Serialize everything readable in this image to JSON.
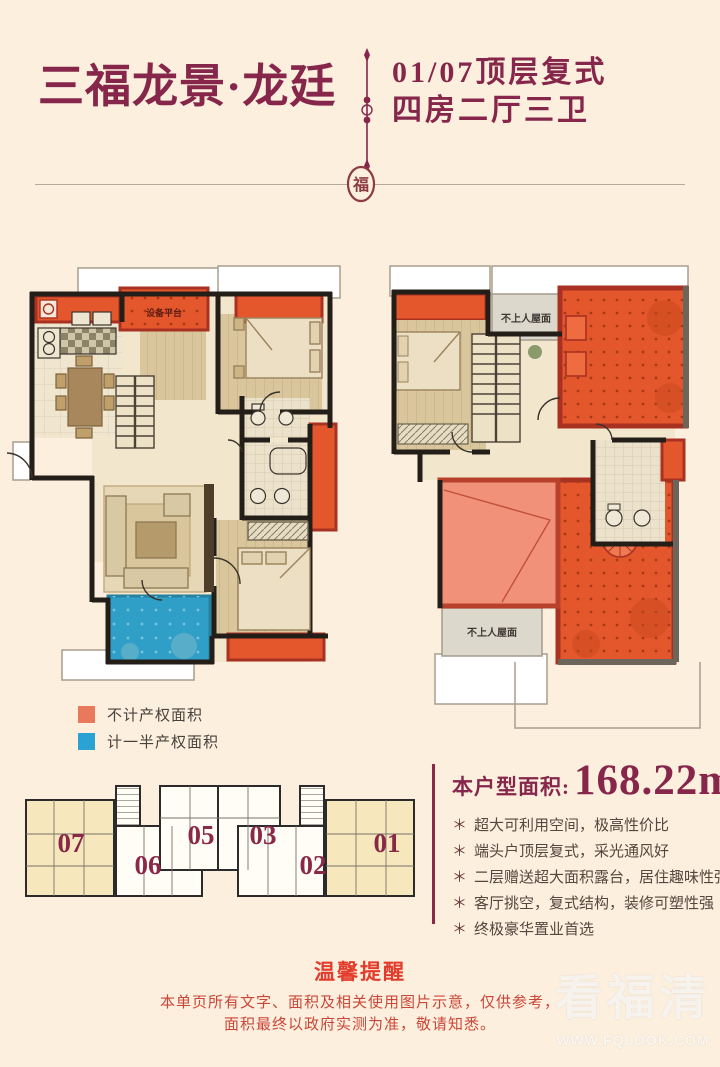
{
  "header": {
    "title": "三福龙景·龙廷",
    "subtitle_line1": "01/07顶层复式",
    "subtitle_line2": "四房二厅三卫",
    "seal_glyph": "福",
    "accent_color": "#85264a"
  },
  "plans": {
    "left": {
      "equipment_platform_label": "设备平台"
    },
    "right": {
      "roof_label_top": "不上人屋面",
      "roof_label_bottom": "不上人屋面"
    },
    "colors": {
      "no_property_area": "#e4572c",
      "half_property_area": "#2f9fc8",
      "void_area": "#f2917a",
      "roof_gray": "#ddd8cc",
      "wall_black": "#241e18",
      "wall_red": "#a93122"
    }
  },
  "legend": {
    "items": [
      {
        "label": "不计产权面积",
        "color": "#e8795a"
      },
      {
        "label": "计一半产权面积",
        "color": "#2aa3d4"
      }
    ]
  },
  "keyplan": {
    "units": [
      {
        "label": "07"
      },
      {
        "label": "06"
      },
      {
        "label": "05"
      },
      {
        "label": "03"
      },
      {
        "label": "02"
      },
      {
        "label": "01"
      }
    ],
    "highlight_color": "#f7e7bd",
    "number_color": "#8a2848"
  },
  "info": {
    "area_label": "本户型面积:",
    "area_value": "168.22m",
    "area_sup": "2",
    "bullet_marker": "＊",
    "bullets": [
      "超大可利用空间，极高性价比",
      "端头户顶层复式，采光通风好",
      "二层赠送超大面积露台，居住趣味性强",
      "客厅挑空，复式结构，装修可塑性强",
      "终极豪华置业首选"
    ]
  },
  "footer": {
    "notice_title": "温馨提醒",
    "notice_line1": "本单页所有文字、面积及相关使用图片示意，仅供参考，",
    "notice_line2": "面积最终以政府实测为准，敬请知悉。"
  },
  "watermark": {
    "brand": "看福清",
    "url": "WWW.FQLOOK.COM"
  }
}
